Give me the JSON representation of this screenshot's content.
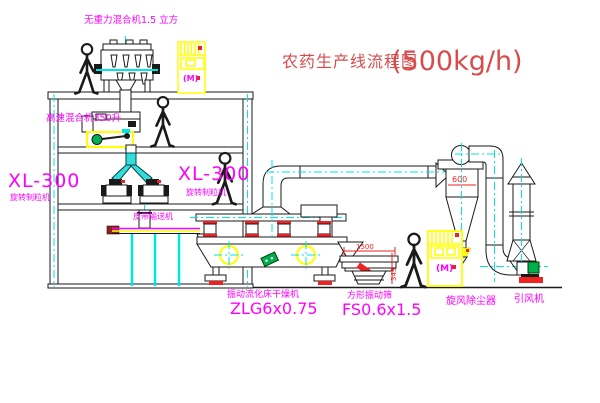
{
  "title": {
    "text": "农药生产线流程图",
    "capacity": "(500kg/h)"
  },
  "equipment": {
    "gravity_mixer_label": "无重力混合机1.5 立方",
    "high_speed_mixer_label": "高速混合机350升",
    "granulator_left": {
      "model": "XL-300",
      "name": "旋转制粒机"
    },
    "granulator_right": {
      "model": "XL-300",
      "name": "旋转制粒机"
    },
    "belt_conveyor_label": "皮带输送机",
    "dryer": {
      "name": "振动流化床干燥机",
      "model": "ZLG6x0.75"
    },
    "sieve": {
      "name": "方形振动筛",
      "model": "FS0.6x1.5"
    },
    "cyclone_label": "旋风除尘器",
    "fan_label": "引风机"
  },
  "dimensions": {
    "cyclone_width": "600",
    "sieve_length": "1500",
    "sieve_height": "345"
  },
  "cabinet_mark": "(M)",
  "colors": {
    "label": "#ff00ff",
    "title": "#d94a4a",
    "dimension": "#ee2222",
    "centerline": "#00e5e5",
    "cabinet_yellow": "#ffff00",
    "motor_green": "#00b050",
    "line": "#1a1a1a",
    "background": "#ffffff"
  }
}
